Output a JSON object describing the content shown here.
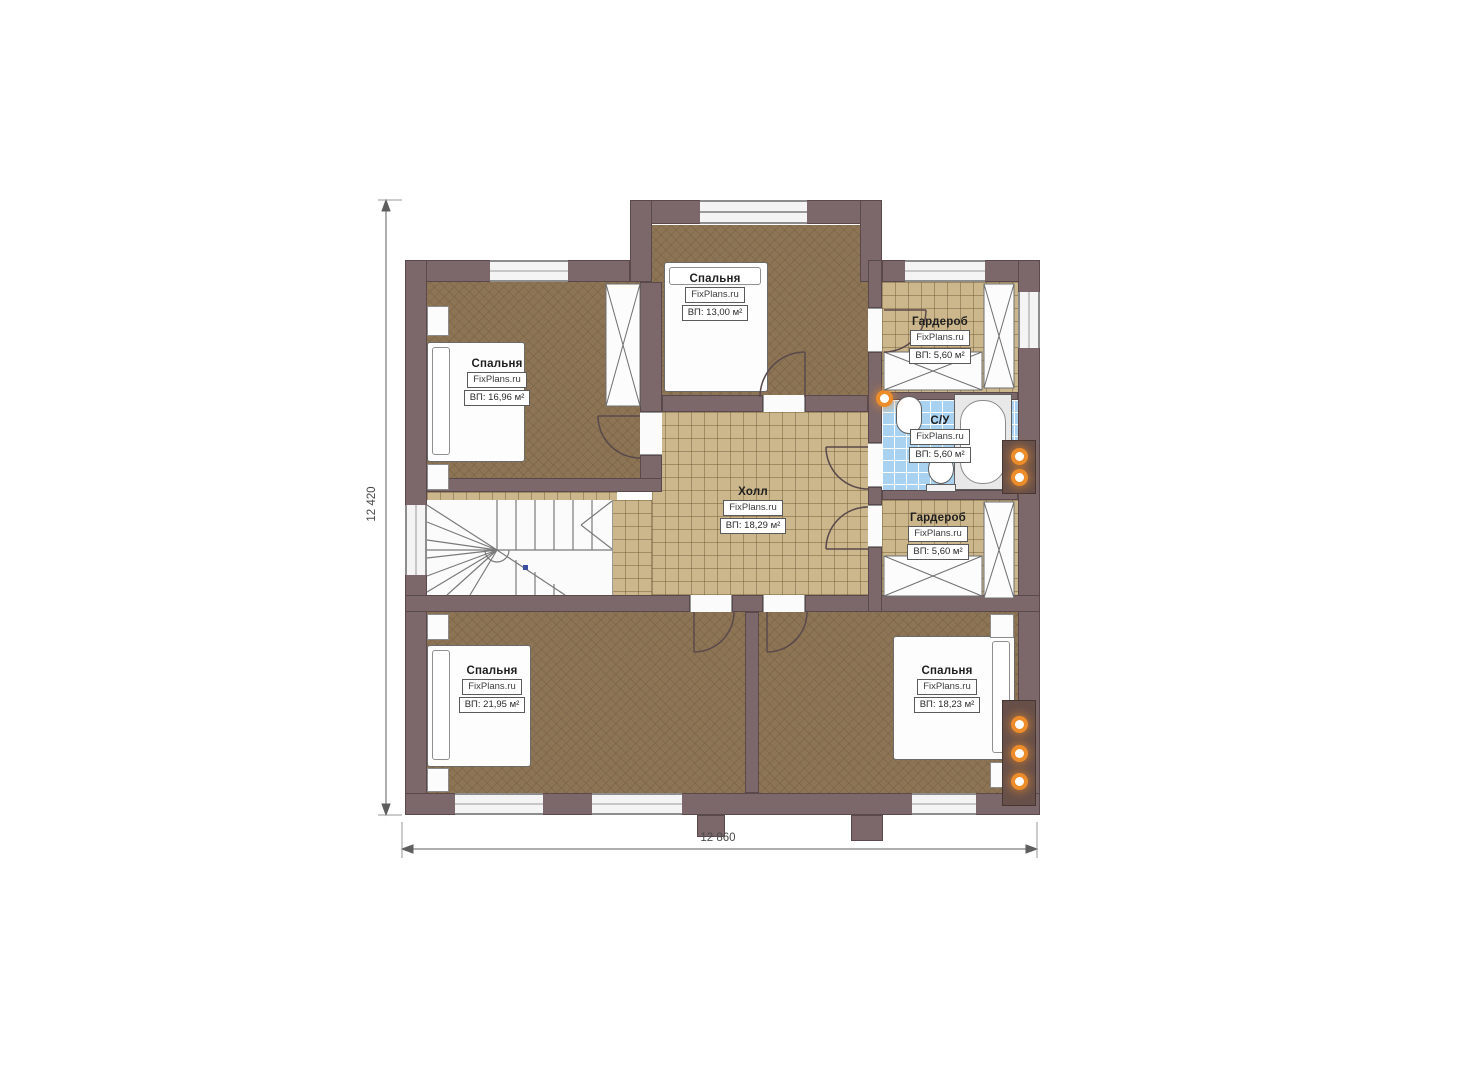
{
  "watermark": "FixPlans.ru",
  "dimensions": {
    "width_label": "12 860",
    "height_label": "12 420"
  },
  "rooms": [
    {
      "name": "Спальня",
      "area": "ВП: 16,96 м²"
    },
    {
      "name": "Спальня",
      "area": "ВП: 13,00 м²"
    },
    {
      "name": "Гардероб",
      "area": "ВП: 5,60 м²"
    },
    {
      "name": "С/У",
      "area": "ВП: 5,60 м²"
    },
    {
      "name": "Гардероб",
      "area": "ВП: 5,60 м²"
    },
    {
      "name": "Холл",
      "area": "ВП: 18,29 м²"
    },
    {
      "name": "Спальня",
      "area": "ВП: 21,95 м²"
    },
    {
      "name": "Спальня",
      "area": "ВП: 18,23 м²"
    }
  ],
  "colors": {
    "wall": "#7c686a",
    "carpet_floor": "#8c7455",
    "tile_floor": "#ccb78c",
    "bathroom_tile": "#a9d2f0",
    "vent_glow": "#ec8c2a",
    "line": "#5a494b"
  }
}
